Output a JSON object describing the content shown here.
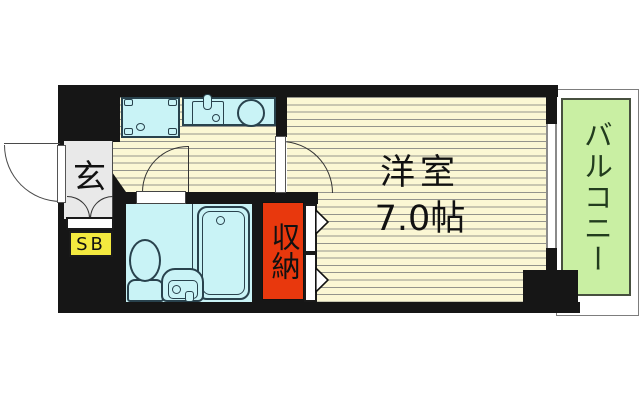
{
  "rooms": {
    "entrance": {
      "label": "玄"
    },
    "shoe_box": {
      "label": "SB"
    },
    "closet": {
      "label": "収納"
    },
    "main_room": {
      "name": "洋室",
      "area": "7.0帖"
    },
    "balcony": {
      "label": "バルコニー"
    }
  },
  "colors": {
    "wall": "#161616",
    "cream": "#fbf7d4",
    "stripe": "#94948c",
    "cyan": "#c9f3f6",
    "outline": "#29424d",
    "red": "#e8380d",
    "yellow": "#f3e93f",
    "gray": "#e9e9e9",
    "green": "#c9efa3",
    "baltext": "#223c1e"
  }
}
